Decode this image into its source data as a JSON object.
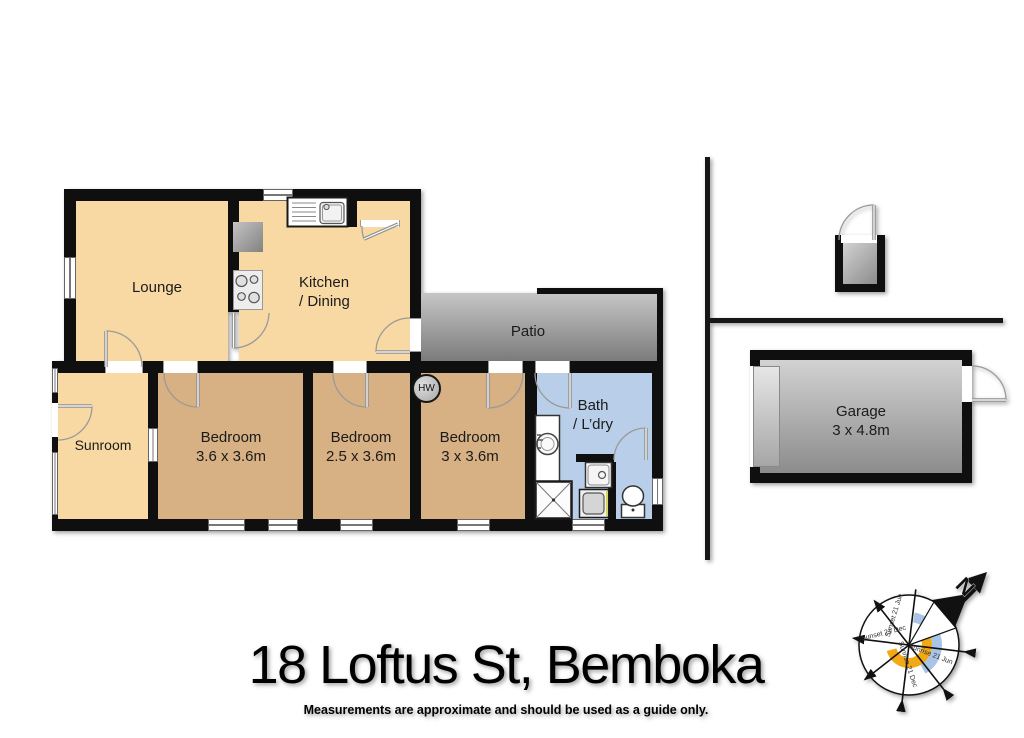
{
  "title": "18 Loftus St, Bemboka",
  "disclaimer": "Measurements are approximate and should be used as a guide only.",
  "rooms": {
    "lounge": {
      "name": "Lounge"
    },
    "kitchen": {
      "line1": "Kitchen",
      "line2": "/ Dining"
    },
    "patio": {
      "name": "Patio"
    },
    "sunroom": {
      "name": "Sunroom"
    },
    "bedroom1": {
      "name": "Bedroom",
      "dims": "3.6 x 3.6m"
    },
    "bedroom2": {
      "name": "Bedroom",
      "dims": "2.5 x 3.6m"
    },
    "bedroom3": {
      "name": "Bedroom",
      "dims": "3 x 3.6m"
    },
    "bath": {
      "line1": "Bath",
      "line2": "/ L’dry"
    },
    "garage": {
      "name": "Garage",
      "dims": "3 x 4.8m"
    }
  },
  "fixtures": {
    "hot_water_label": "HW"
  },
  "compass": {
    "north": "N",
    "labels": {
      "sunset_jun": "Sunset 21 Jun",
      "sunset_dec": "Sunset 21 Dec",
      "sunrise_dec": "Sunrise 21 Dec",
      "sunrise_jun": "Sunrise 21 Jun"
    }
  },
  "colors": {
    "wall": "#0f0f0f",
    "peach": "#f8d8a3",
    "tan": "#d7b083",
    "bath-blue": "#b9cfe9",
    "patio-top": "#c6c6c6",
    "patio-bottom": "#7b7b7b",
    "outbuilding-top": "#d2d2d2",
    "outbuilding-bottom": "#8c8c8c",
    "sun-yellow": "#f2a915",
    "sun-blue": "#a9c4e6"
  }
}
